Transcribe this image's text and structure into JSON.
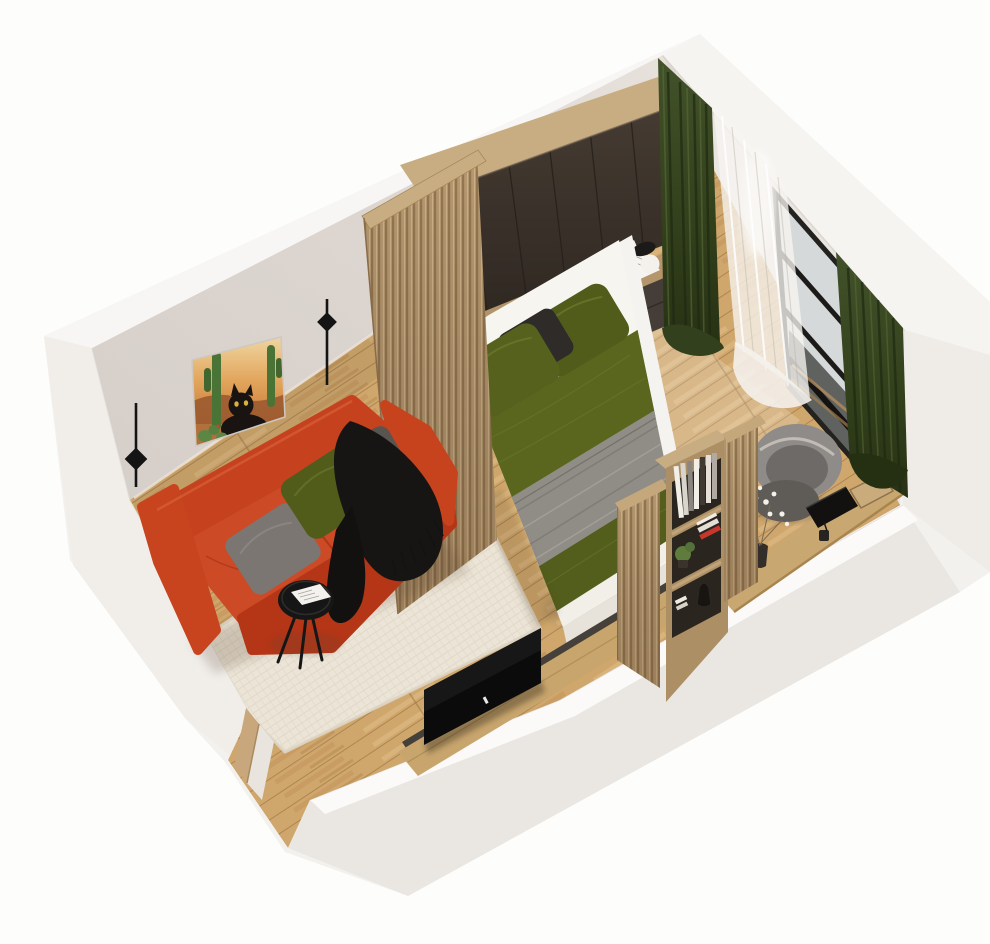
{
  "image": {
    "width": 990,
    "height": 944,
    "description": "Isometric 3D cutaway render of a studio bedroom: red sofa with cushions, cream rug, black coffee table, cat-and-cactus artwork, two black wall sconces, wood slat partitions, dark oak wardrobe over bed with olive green bedding and grey throw blanket, nightstand with lamp, green curtains with sheer and window, desk with laptop and grey chair, slatted bookshelf divider, TV on oak board, white cutaway walls with door opening"
  },
  "palette": {
    "background_top": "#fdfdfc",
    "background_bottom": "#f3f2f0",
    "shell_white": "#f3f1ee",
    "shell_bright": "#f8f6f4",
    "shell_shaded": "#efece8",
    "shell_deep": "#eae7e2",
    "wall_grey": "#dcd5d0",
    "wall_grey_right": "#e9e5e1",
    "rug_cream": "#ece5d7",
    "sofa_red": "#c6421f",
    "sofa_red_bright": "#cc4a25",
    "sofa_red_dark": "#b53517",
    "sofa_red_deep": "#a02a10",
    "pillow_grey": "#7b7672",
    "pillow_grey_dark": "#59544f",
    "pillow_olive": "#515c1b",
    "pillow_olive_b": "#56611d",
    "pillow_charcoal": "#2e2b28",
    "throw_black": "#171514",
    "table_black": "#161616",
    "slat_wood": "#b79a71",
    "oak_light": "#c9ad82",
    "oak_mid": "#b2936a",
    "wardrobe_brown": "#3a322b",
    "wardrobe_side": "#241e18",
    "niche_dark": "#262019",
    "bed_white": "#f5f3ef",
    "sheet_white": "#f7f5f0",
    "duvet_olive": "#5a661e",
    "blanket_grey": "#908d87",
    "curtain_green": "#36441d",
    "curtain_green_dark": "#253013",
    "sheer_white": "#f7f5f1",
    "window_frame": "#23221f",
    "window_glass": "#d6d9da",
    "nightstand_dark": "#453e38",
    "chair_grey": "#8f8b88",
    "chair_grey_mid": "#6e6a67",
    "chair_grey_dark": "#5f5b57",
    "desk_oak": "#c9a770",
    "tv_black": "#0b0b0b",
    "tv_board": "#c8a56d",
    "door_wood": "#c8a77c",
    "lamp_black": "#1c1a18",
    "plant_green": "#5f7c3c",
    "art_green": "#4a7336",
    "art_ground": "#b0713c",
    "magazine_white": "#f6f4f0",
    "floor_light_wedge": "#ffffff"
  },
  "scene": {
    "objects": [
      {
        "name": "room-shell",
        "description": "white cutaway wall slabs around isometric room"
      },
      {
        "name": "floor",
        "description": "light oak plank floor"
      },
      {
        "name": "area-rug",
        "description": "cream textured rug in living area"
      },
      {
        "name": "cat-artwork",
        "description": "framed print of black cat among cacti at sunset"
      },
      {
        "name": "wall-sconces",
        "description": "two black line-and-diamond wall lamps"
      },
      {
        "name": "sofa",
        "description": "red-orange two-seat sofa with grey, olive and charcoal pillows and black fringed throw"
      },
      {
        "name": "coffee-table",
        "description": "round black tripod table with open magazine"
      },
      {
        "name": "slat-partition-bedroom",
        "description": "vertical oak slat screen between sofa and bed"
      },
      {
        "name": "wardrobe",
        "description": "dark brown wardrobe with oak frame and open book niches over bed head"
      },
      {
        "name": "bed",
        "description": "double bed, white linen, olive duvet bands, grey ribbed blanket, olive pillows"
      },
      {
        "name": "nightstand",
        "description": "dark chest with oak top, open magazine and sphere lamp"
      },
      {
        "name": "curtains",
        "description": "dark green curtains with white sheer and black framed window"
      },
      {
        "name": "desk-zone",
        "description": "oak desk with closed laptop, tray, pen cup, flower vase and grey shell chair"
      },
      {
        "name": "slat-partition-desk",
        "description": "slatted divider with open bookshelf, plant and figurine"
      },
      {
        "name": "tv",
        "description": "black flat TV standing on oak media board"
      },
      {
        "name": "door-frame",
        "description": "wood door jamb in cutaway wall opening"
      }
    ]
  }
}
